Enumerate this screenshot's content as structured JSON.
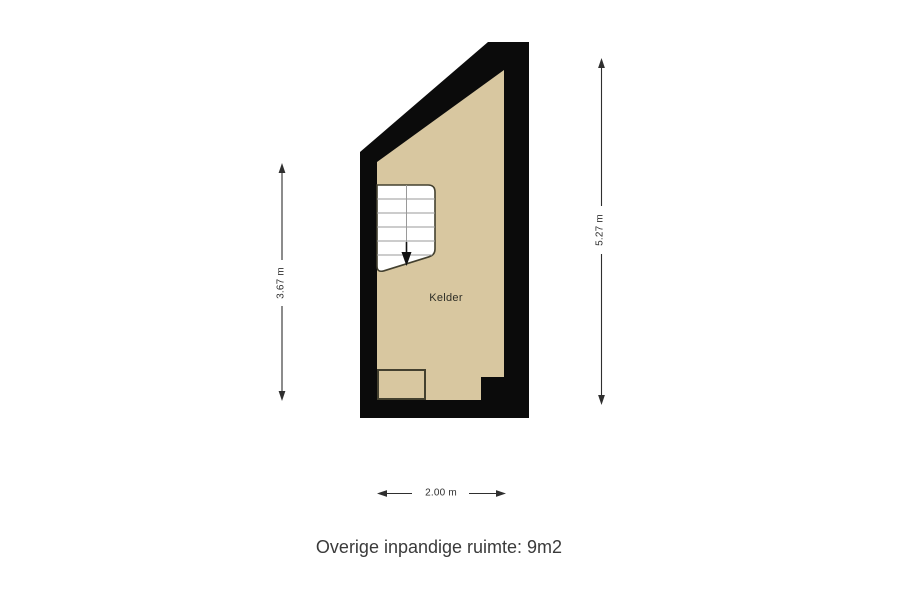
{
  "floorplan": {
    "room": {
      "label": "Kelder"
    },
    "caption": "Overige inpandige ruimte: 9m2",
    "dimensions": {
      "left_height": "3.67 m",
      "right_height": "5.27 m",
      "bottom_width": "2.00 m"
    },
    "stairs": {
      "direction": "down"
    },
    "colors": {
      "wall": "#0b0b0b",
      "floor": "#d8c7a0",
      "stair_fill": "#ffffff",
      "stair_tread_line": "#9a9a9a",
      "stair_outline": "#43402f",
      "dimension_line": "#2f2f2f",
      "text": "#3a3a3a",
      "background": "#ffffff"
    }
  }
}
